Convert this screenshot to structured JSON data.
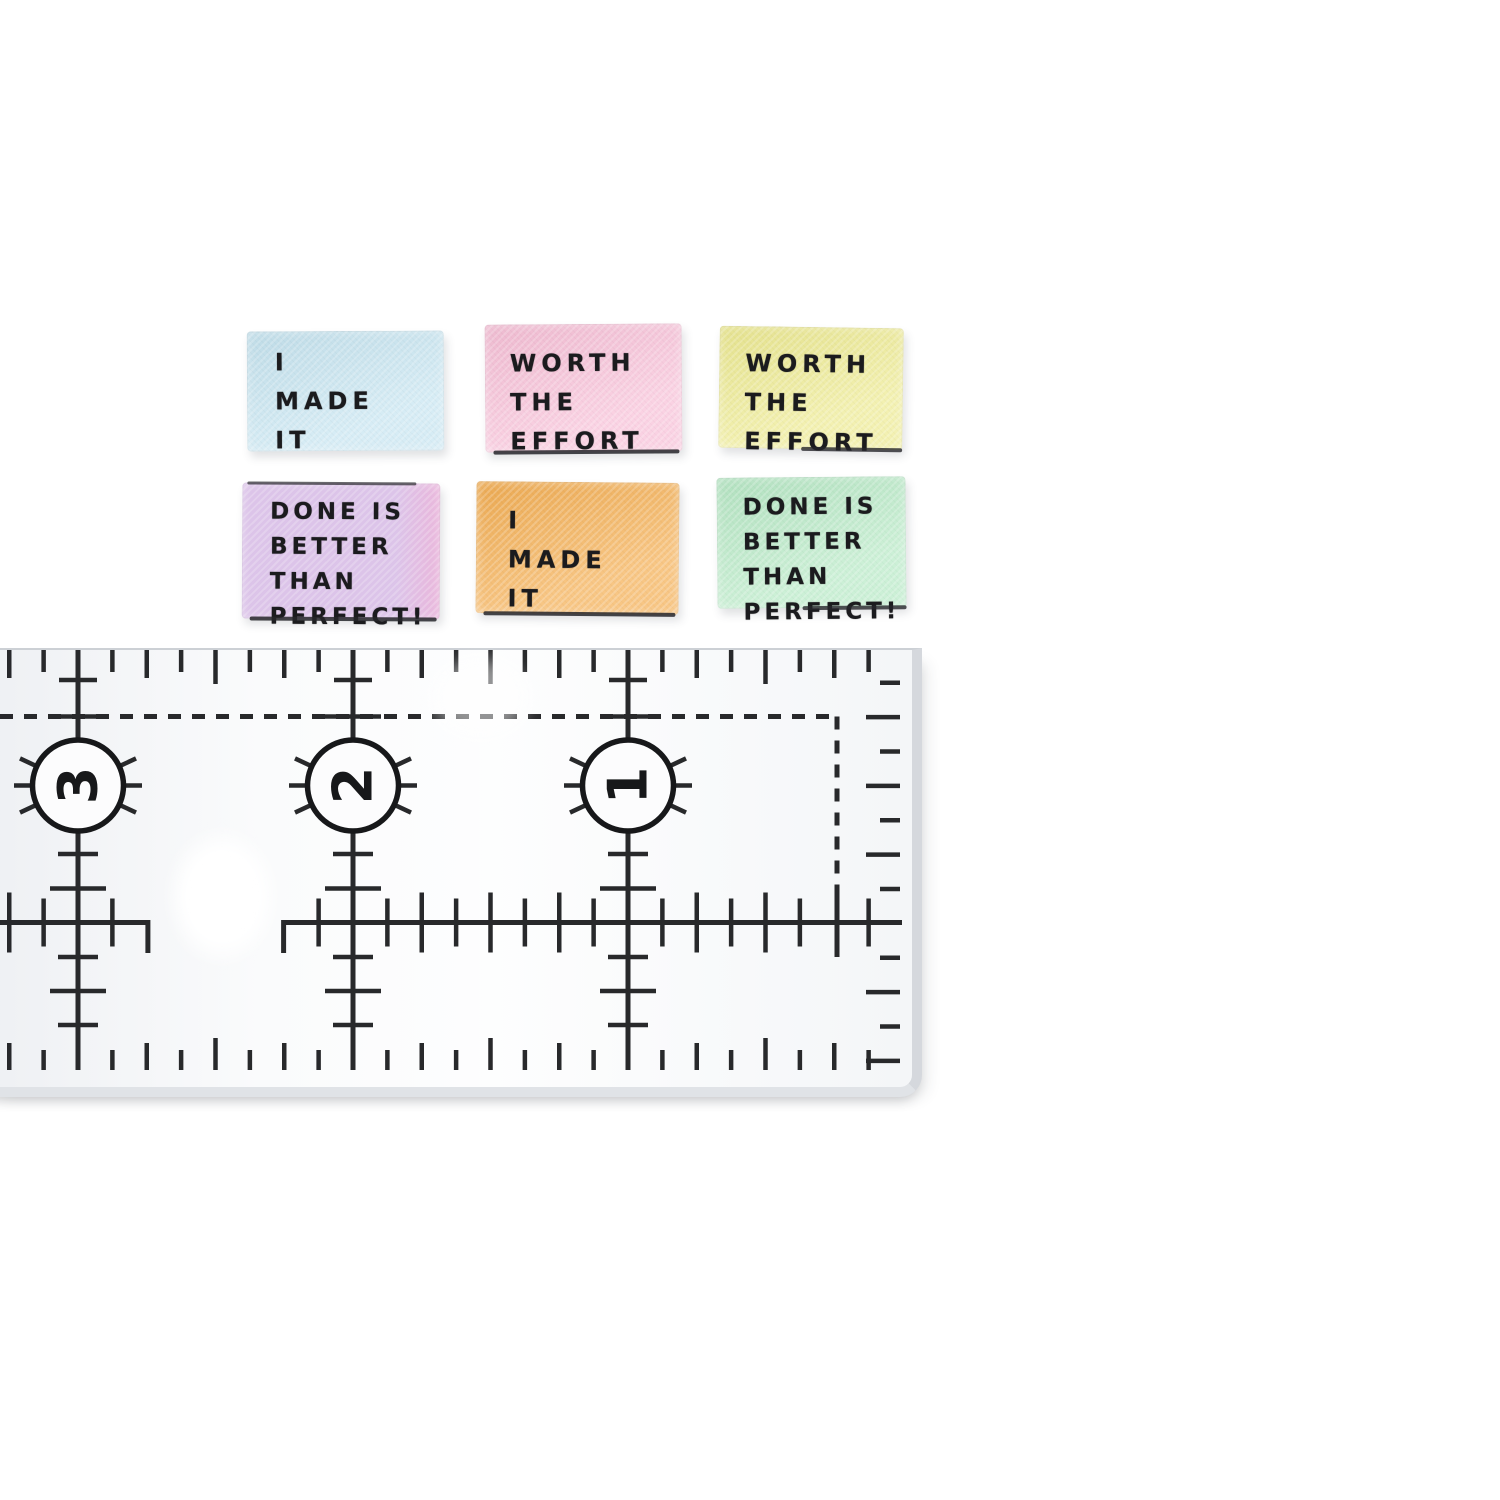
{
  "labels": [
    {
      "id": "blue",
      "text": "I\nMADE\nIT",
      "color": "#c7e5f1"
    },
    {
      "id": "pink",
      "text": "WORTH\nTHE\nEFFORT",
      "color": "#f8c1d8"
    },
    {
      "id": "yellow",
      "text": "WORTH\nTHE\nEFFORT",
      "color": "#eeeb93"
    },
    {
      "id": "lilac",
      "text": "DONE IS\nBETTER\nTHAN\nPERFECT!",
      "color": "#dcc4e9"
    },
    {
      "id": "orange",
      "text": "I\nMADE\nIT",
      "color": "#f5b055"
    },
    {
      "id": "mint",
      "text": "DONE IS\nBETTER\nTHAN\nPERFECT!",
      "color": "#b9eac7"
    }
  ],
  "ruler": {
    "markers": [
      "3",
      "2",
      "1"
    ],
    "mark_color": "#17181a"
  }
}
